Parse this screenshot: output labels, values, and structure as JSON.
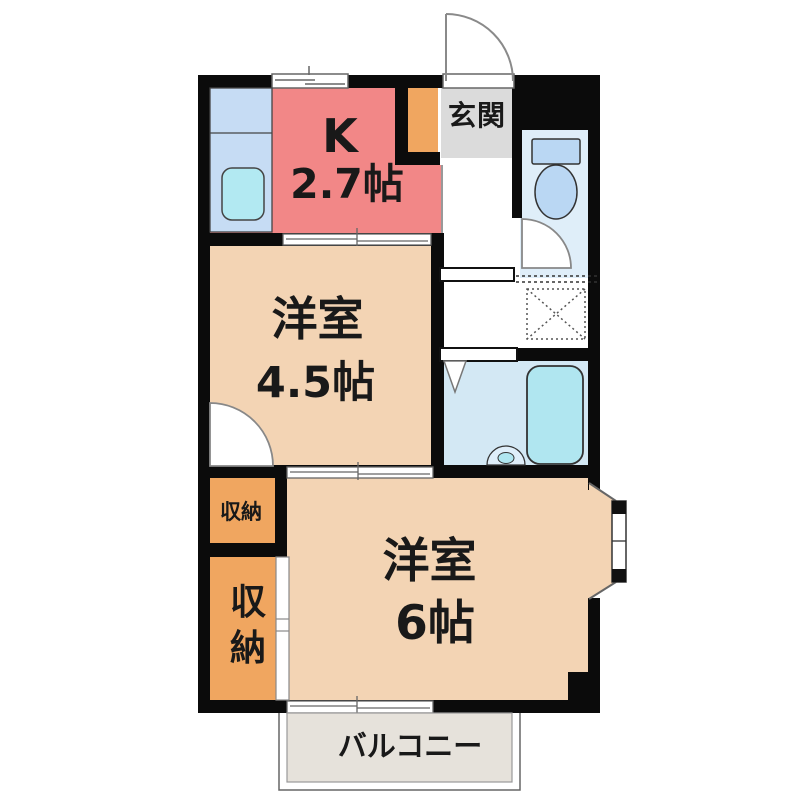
{
  "floorplan": {
    "rooms": {
      "kitchen": {
        "label": "K",
        "size": "2.7帖"
      },
      "entrance": {
        "label": "玄関"
      },
      "western_room_small": {
        "label": "洋室",
        "size": "4.5帖"
      },
      "western_room_large": {
        "label": "洋室",
        "size": "6帖"
      },
      "storage_upper": {
        "label": "収納"
      },
      "storage_lower": {
        "label": "収納"
      },
      "balcony": {
        "label": "バルコニー"
      }
    },
    "fixture_icons": [
      "toilet-icon",
      "bathtub-icon",
      "kitchen-sink-icon",
      "washbasin-icon",
      "washing-machine-space-icon",
      "entrance-door-arc",
      "toilet-door-arc",
      "closet-door-arc",
      "folding-door-icon",
      "bay-window",
      "sliding-window"
    ],
    "colors": {
      "wall": "#0b0b0b",
      "kitchen": "#F28787",
      "western_room": "#F3D4B4",
      "storage": "#F0A660",
      "entrance": "#DBDBDB",
      "toilet_room": "#DFEEF9",
      "fixture_blue": "#BAD7F3",
      "counter": "#C6DCF4",
      "sink": "#B2E9F2",
      "washroom": "#D3E8F4",
      "bathtub": "#B0E6F0",
      "balcony": "#E6E2DB"
    }
  }
}
